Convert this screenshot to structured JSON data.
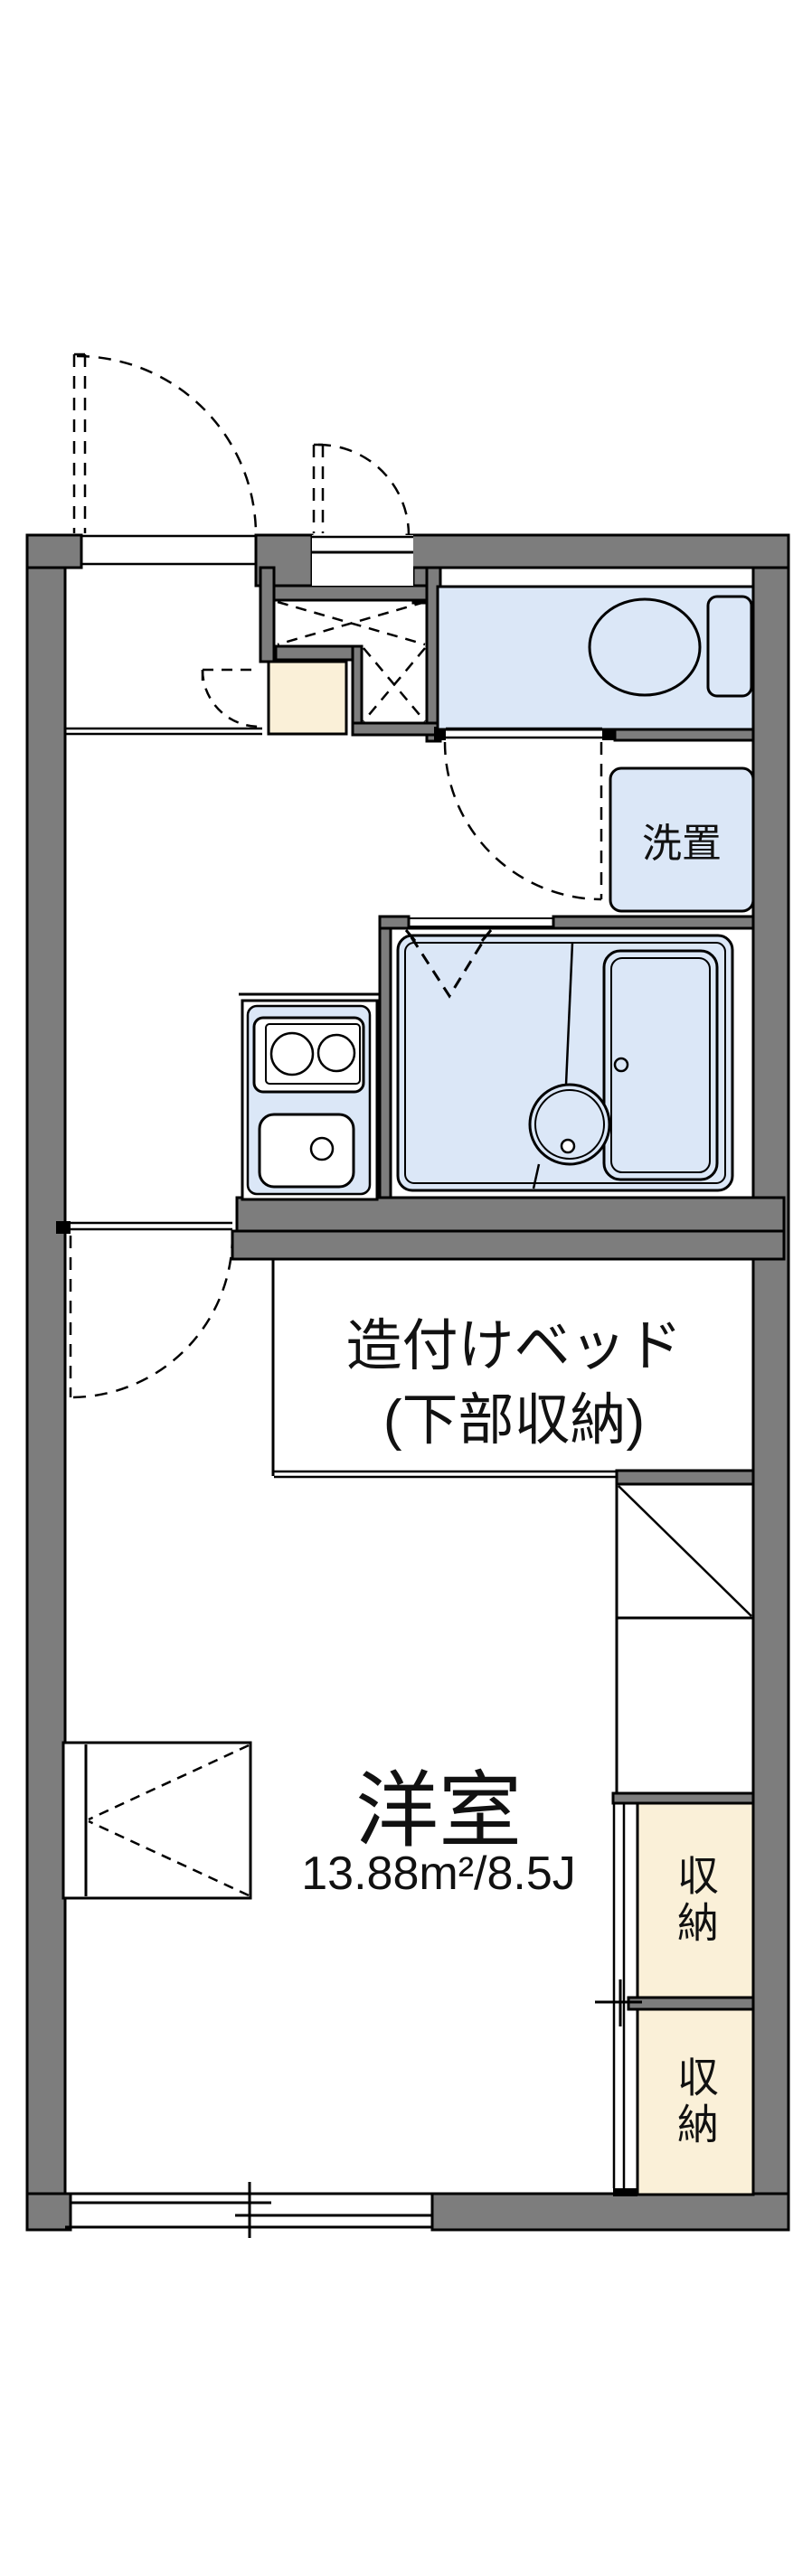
{
  "floorplan": {
    "labels": {
      "laundry": "洗置",
      "bed_line1": "造付けベッド",
      "bed_line2": "(下部収納)",
      "room_name": "洋室",
      "room_area": "13.88m²/8.5J",
      "storage_upper": "収納",
      "storage_lower": "収納"
    },
    "colors": {
      "wall": "#7d7d7d",
      "wet_area": "#dbe7f7",
      "storage_area": "#faf0d8",
      "outline": "#000000",
      "background": "#ffffff"
    }
  }
}
